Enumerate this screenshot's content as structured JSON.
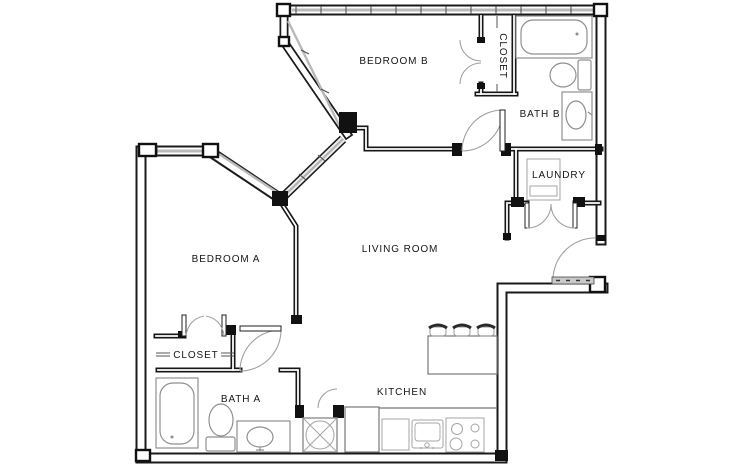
{
  "floor_plan": {
    "rooms": {
      "bedroom_b": {
        "label": "BEDROOM B"
      },
      "closet_b": {
        "label": "CLOSET"
      },
      "bath_b": {
        "label": "BATH B"
      },
      "laundry": {
        "label": "LAUNDRY"
      },
      "bedroom_a": {
        "label": "BEDROOM A"
      },
      "living_room": {
        "label": "LIVING ROOM"
      },
      "closet_a": {
        "label": "CLOSET"
      },
      "bath_a": {
        "label": "BATH A"
      },
      "kitchen": {
        "label": "KITCHEN"
      }
    },
    "fixtures": [
      "bathtub-a",
      "toilet-a",
      "sink-vanity-a",
      "water-heater",
      "bathtub-b",
      "toilet-b",
      "sink-vanity-b",
      "washer-dryer",
      "kitchen-island",
      "bar-stools",
      "refrigerator",
      "dishwasher",
      "kitchen-sink",
      "stove",
      "entry-threshold"
    ],
    "colors": {
      "wall_ink": "#1a1a1a",
      "window_glass": "#b9b9b9",
      "fixture_line": "#8f8f8f",
      "door_arc": "#a0a0a0",
      "threshold": "#c9c9c9",
      "background": "#ffffff"
    }
  }
}
